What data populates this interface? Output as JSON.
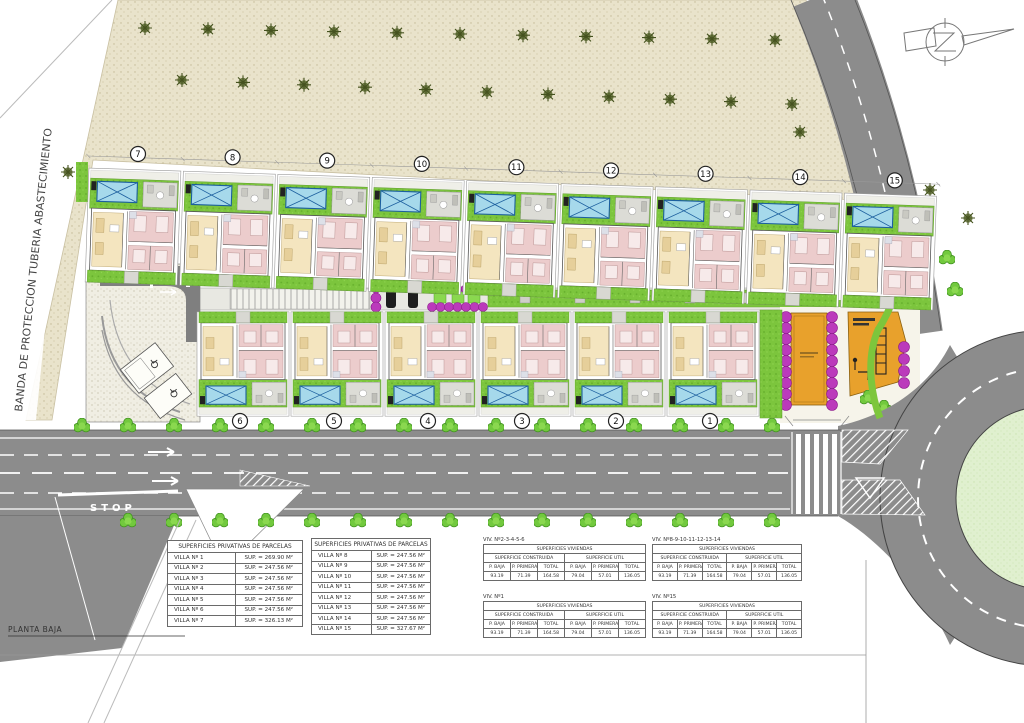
{
  "labels": {
    "band": "BANDA DE PROTECCION TUBERIA ABASTECIMIENTO",
    "planta_baja": "PLANTA BAJA",
    "stop": "STOP"
  },
  "villas": {
    "top_row": [
      "7",
      "8",
      "9",
      "10",
      "11",
      "12",
      "13",
      "14",
      "15"
    ],
    "bottom_row": [
      "6",
      "5",
      "4",
      "3",
      "2",
      "1"
    ]
  },
  "parcel_tables": [
    {
      "title": "SUPERFICIES PRIVATIVAS DE PARCELAS",
      "rows": [
        [
          "VILLA Nº 1",
          "SUP. = 269.90 M²"
        ],
        [
          "VILLA Nº 2",
          "SUP. = 247.56 M²"
        ],
        [
          "VILLA Nº 3",
          "SUP. = 247.56 M²"
        ],
        [
          "VILLA Nº 4",
          "SUP. = 247.56 M²"
        ],
        [
          "VILLA Nº 5",
          "SUP. = 247.56 M²"
        ],
        [
          "VILLA Nº 6",
          "SUP. = 247.56 M²"
        ],
        [
          "VILLA Nº 7",
          "SUP. = 326.13 M²"
        ]
      ]
    },
    {
      "title": "SUPERFICIES PRIVATIVAS DE PARCELAS",
      "rows": [
        [
          "VILLA Nº 8",
          "SUP. = 247.56 M²"
        ],
        [
          "VILLA Nº 9",
          "SUP. = 247.56 M²"
        ],
        [
          "VILLA Nº 10",
          "SUP. = 247.56 M²"
        ],
        [
          "VILLA Nº 11",
          "SUP. = 247.56 M²"
        ],
        [
          "VILLA Nº 12",
          "SUP. = 247.56 M²"
        ],
        [
          "VILLA Nº 13",
          "SUP. = 247.56 M²"
        ],
        [
          "VILLA Nº 14",
          "SUP. = 247.56 M²"
        ],
        [
          "VILLA Nº 15",
          "SUP. = 327.67 M²"
        ]
      ]
    }
  ],
  "dwelling_tables": [
    {
      "header": "VIV. Nº2-3-4-5-6",
      "title": "SUPERFICIES VIVIENDAS",
      "group_headers": [
        "SUPERFICIE CONSTRUIDA",
        "SUPERFICIE UTIL"
      ],
      "col_headers": [
        "P. BAJA",
        "P. PRIMERA",
        "TOTAL",
        "P. BAJA",
        "P. PRIMERA",
        "TOTAL"
      ],
      "values": [
        "93.19",
        "71.39",
        "164.58",
        "79.04",
        "57.01",
        "136.05"
      ]
    },
    {
      "header": "VIV. Nº1",
      "title": "SUPERFICIES VIVIENDAS",
      "group_headers": [
        "SUPERFICIE CONSTRUIDA",
        "SUPERFICIE UTIL"
      ],
      "col_headers": [
        "P. BAJA",
        "P. PRIMERA",
        "TOTAL",
        "P. BAJA",
        "P. PRIMERA",
        "TOTAL"
      ],
      "values": [
        "93.19",
        "71.39",
        "164.58",
        "79.04",
        "57.01",
        "136.05"
      ]
    },
    {
      "header": "VIV. Nº8-9-10-11-12-13-14",
      "title": "SUPERFICIES VIVIENDAS",
      "group_headers": [
        "SUPERFICIE CONSTRUIDA",
        "SUPERFICIE UTIL"
      ],
      "col_headers": [
        "P. BAJA",
        "P. PRIMERA",
        "TOTAL",
        "P. BAJA",
        "P. PRIMERA",
        "TOTAL"
      ],
      "values": [
        "93.19",
        "71.39",
        "164.58",
        "79.04",
        "57.01",
        "136.05"
      ]
    },
    {
      "header": "VIV. Nº15",
      "title": "SUPERFICIES VIVIENDAS",
      "group_headers": [
        "SUPERFICIE CONSTRUIDA",
        "SUPERFICIE UTIL"
      ],
      "col_headers": [
        "P. BAJA",
        "P. PRIMERA",
        "TOTAL",
        "P. BAJA",
        "P. PRIMERA",
        "TOTAL"
      ],
      "values": [
        "93.19",
        "71.39",
        "164.58",
        "79.04",
        "57.01",
        "136.05"
      ]
    }
  ],
  "colors": {
    "band_beige": "#e9e3cb",
    "road_gray": "#8c8c8c",
    "lawn_green": "#7cc53d",
    "pool_blue": "#a6d9eb",
    "pool_line": "#1c5f9e",
    "room_pink": "#eccccc",
    "room_cream": "#f4e5bf",
    "bush_purple": "#bb3abb",
    "amenity_orange": "#e8a12c",
    "roundabout_green": "#e0f0cf"
  }
}
